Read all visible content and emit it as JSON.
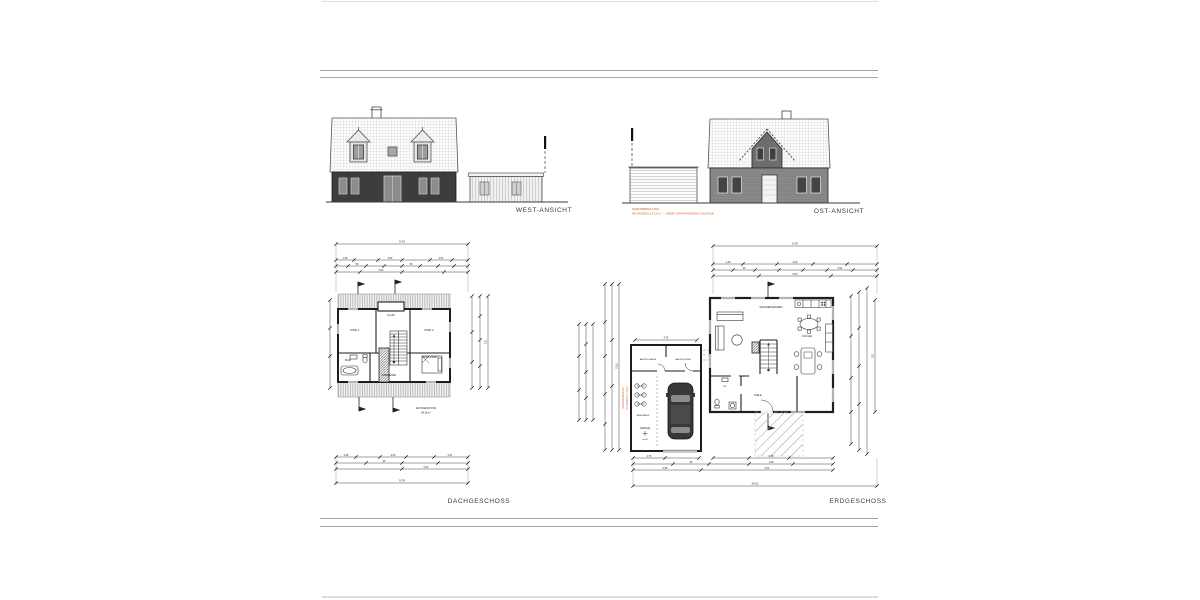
{
  "sheet": {
    "background": "#ffffff",
    "border_line_color": "#a6a6a6",
    "ink_color": "#2b2b2b",
    "accent_color": "#d85a2b"
  },
  "elevations": {
    "west": {
      "label": "WEST-ANSICHT"
    },
    "east": {
      "label": "OST-ANSICHT",
      "note_line1": "GRENZBEBAUUNG",
      "note_line2": "IM GANZEN ≤ 13,0 m — ÜBER VORHANDENEM GELÄNDE"
    }
  },
  "plans": {
    "dachgeschoss": {
      "label": "DACHGESCHOSS",
      "area_note_line1": "DACHGESCHOSS",
      "area_note_line2": "84,18 m²",
      "rooms": {
        "kind1": "KIND 1",
        "kind2": "KIND 2",
        "flur": "FLUR",
        "schlafen": "SCHLAFEN",
        "bad": "BAD",
        "ankleide": "ANKLEIDE"
      }
    },
    "erdgeschoss": {
      "label": "ERDGESCHOSS",
      "rooms": {
        "wohnen_essen": "WOHNEN/ESSEN",
        "kueche": "KÜCHE",
        "diele": "DIELE",
        "wc": "WC",
        "abstellraum": "ABSTELLRAUM",
        "haustechnik": "HAUSTECHNIK",
        "fahrraeder": "FAHRRÄDER",
        "garage": "GARAGE"
      },
      "garage_level_mark": "±0,00",
      "garage_note_line1": "GRENZBEBAUUNG",
      "garage_note_line2": "IM GANZEN ≤ 13,0 m"
    }
  },
  "dims": {
    "numbers": [
      "9,76",
      "7,01",
      "5,63",
      "3,63",
      "2,51",
      "1,38",
      "95",
      "4,75",
      "14,51",
      "10,51",
      "6,98"
    ]
  }
}
